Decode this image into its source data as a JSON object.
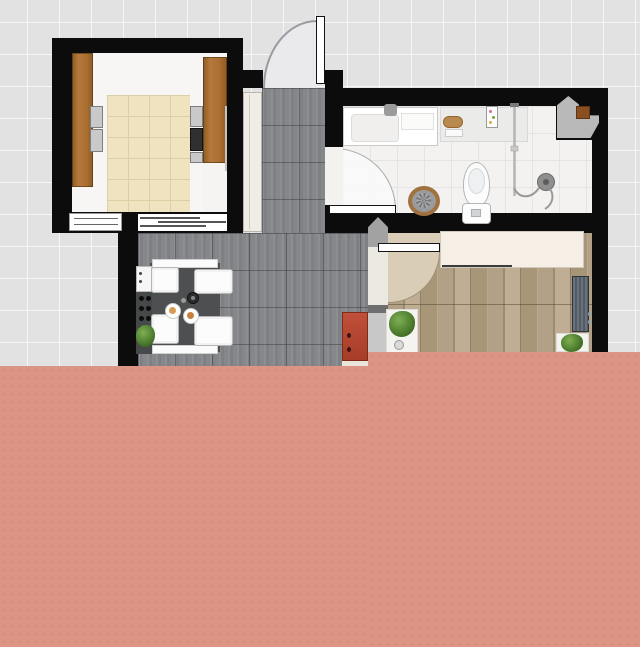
{
  "title": "Apartment floor plan — top-down 2D view, bottom portion covered by salmon overlay",
  "rooms": [
    {
      "id": "kitchen",
      "name": "Kitchen"
    },
    {
      "id": "hallway",
      "name": "Hallway"
    },
    {
      "id": "dining",
      "name": "Dining area"
    },
    {
      "id": "bathroom",
      "name": "Bathroom"
    },
    {
      "id": "bedroom",
      "name": "Bedroom"
    }
  ],
  "labels": {
    "entry_door": "Entry door with outward swing",
    "bathroom_door": "Bathroom door with inward swing",
    "bedroom_door": "Bedroom door with inward swing",
    "hall_closet": "Hall closet",
    "dining_table": "Dining table with four chairs",
    "bottle_rack": "Bottle rack cabinet",
    "red_cabinet": "Red cabinet",
    "kitchen_counter": "Kitchen counter with cabinets",
    "oven": "Built-in oven",
    "stove": "Stove",
    "bathtub": "Washbasin / bath unit",
    "toilet": "Toilet",
    "shower": "Shower with hand-held head",
    "laundry_basket": "Wicker laundry basket",
    "wardrobe": "Wardrobe",
    "radiator": "Radiator",
    "plant": "Potted plant",
    "corner_unit": "Corner duct with wood box",
    "overlay": "Salmon colored overlay covering lower half"
  },
  "palette": {
    "background_grid": "#e2e2e3",
    "grid_line": "#f6f6f7",
    "wall": "#0c0c0c",
    "overlay_salmon": "#dc9484",
    "kitchen_floor": "#efe3c0",
    "cabinet_wood": "#a9702f",
    "counter_marble": "#f7f6f4",
    "hall_tile": "#85878a",
    "bathroom_floor": "#f3f2f0",
    "bedroom_wood": "#ab9a7e",
    "wardrobe_cream": "#f6efe6",
    "radiator_slate": "#525b65",
    "red_cabinet": "#b2452e",
    "door_swing_fill": "#eaeaec",
    "plant_green": "#4e7e2f",
    "table_dark": "#4e4f50",
    "corner_unit_gray": "#b9b9b9",
    "corner_unit_wood": "#8a4f21"
  },
  "overlay_geometry": {
    "left_top_y": 366,
    "right_top_y": 352,
    "step_x": 368
  }
}
